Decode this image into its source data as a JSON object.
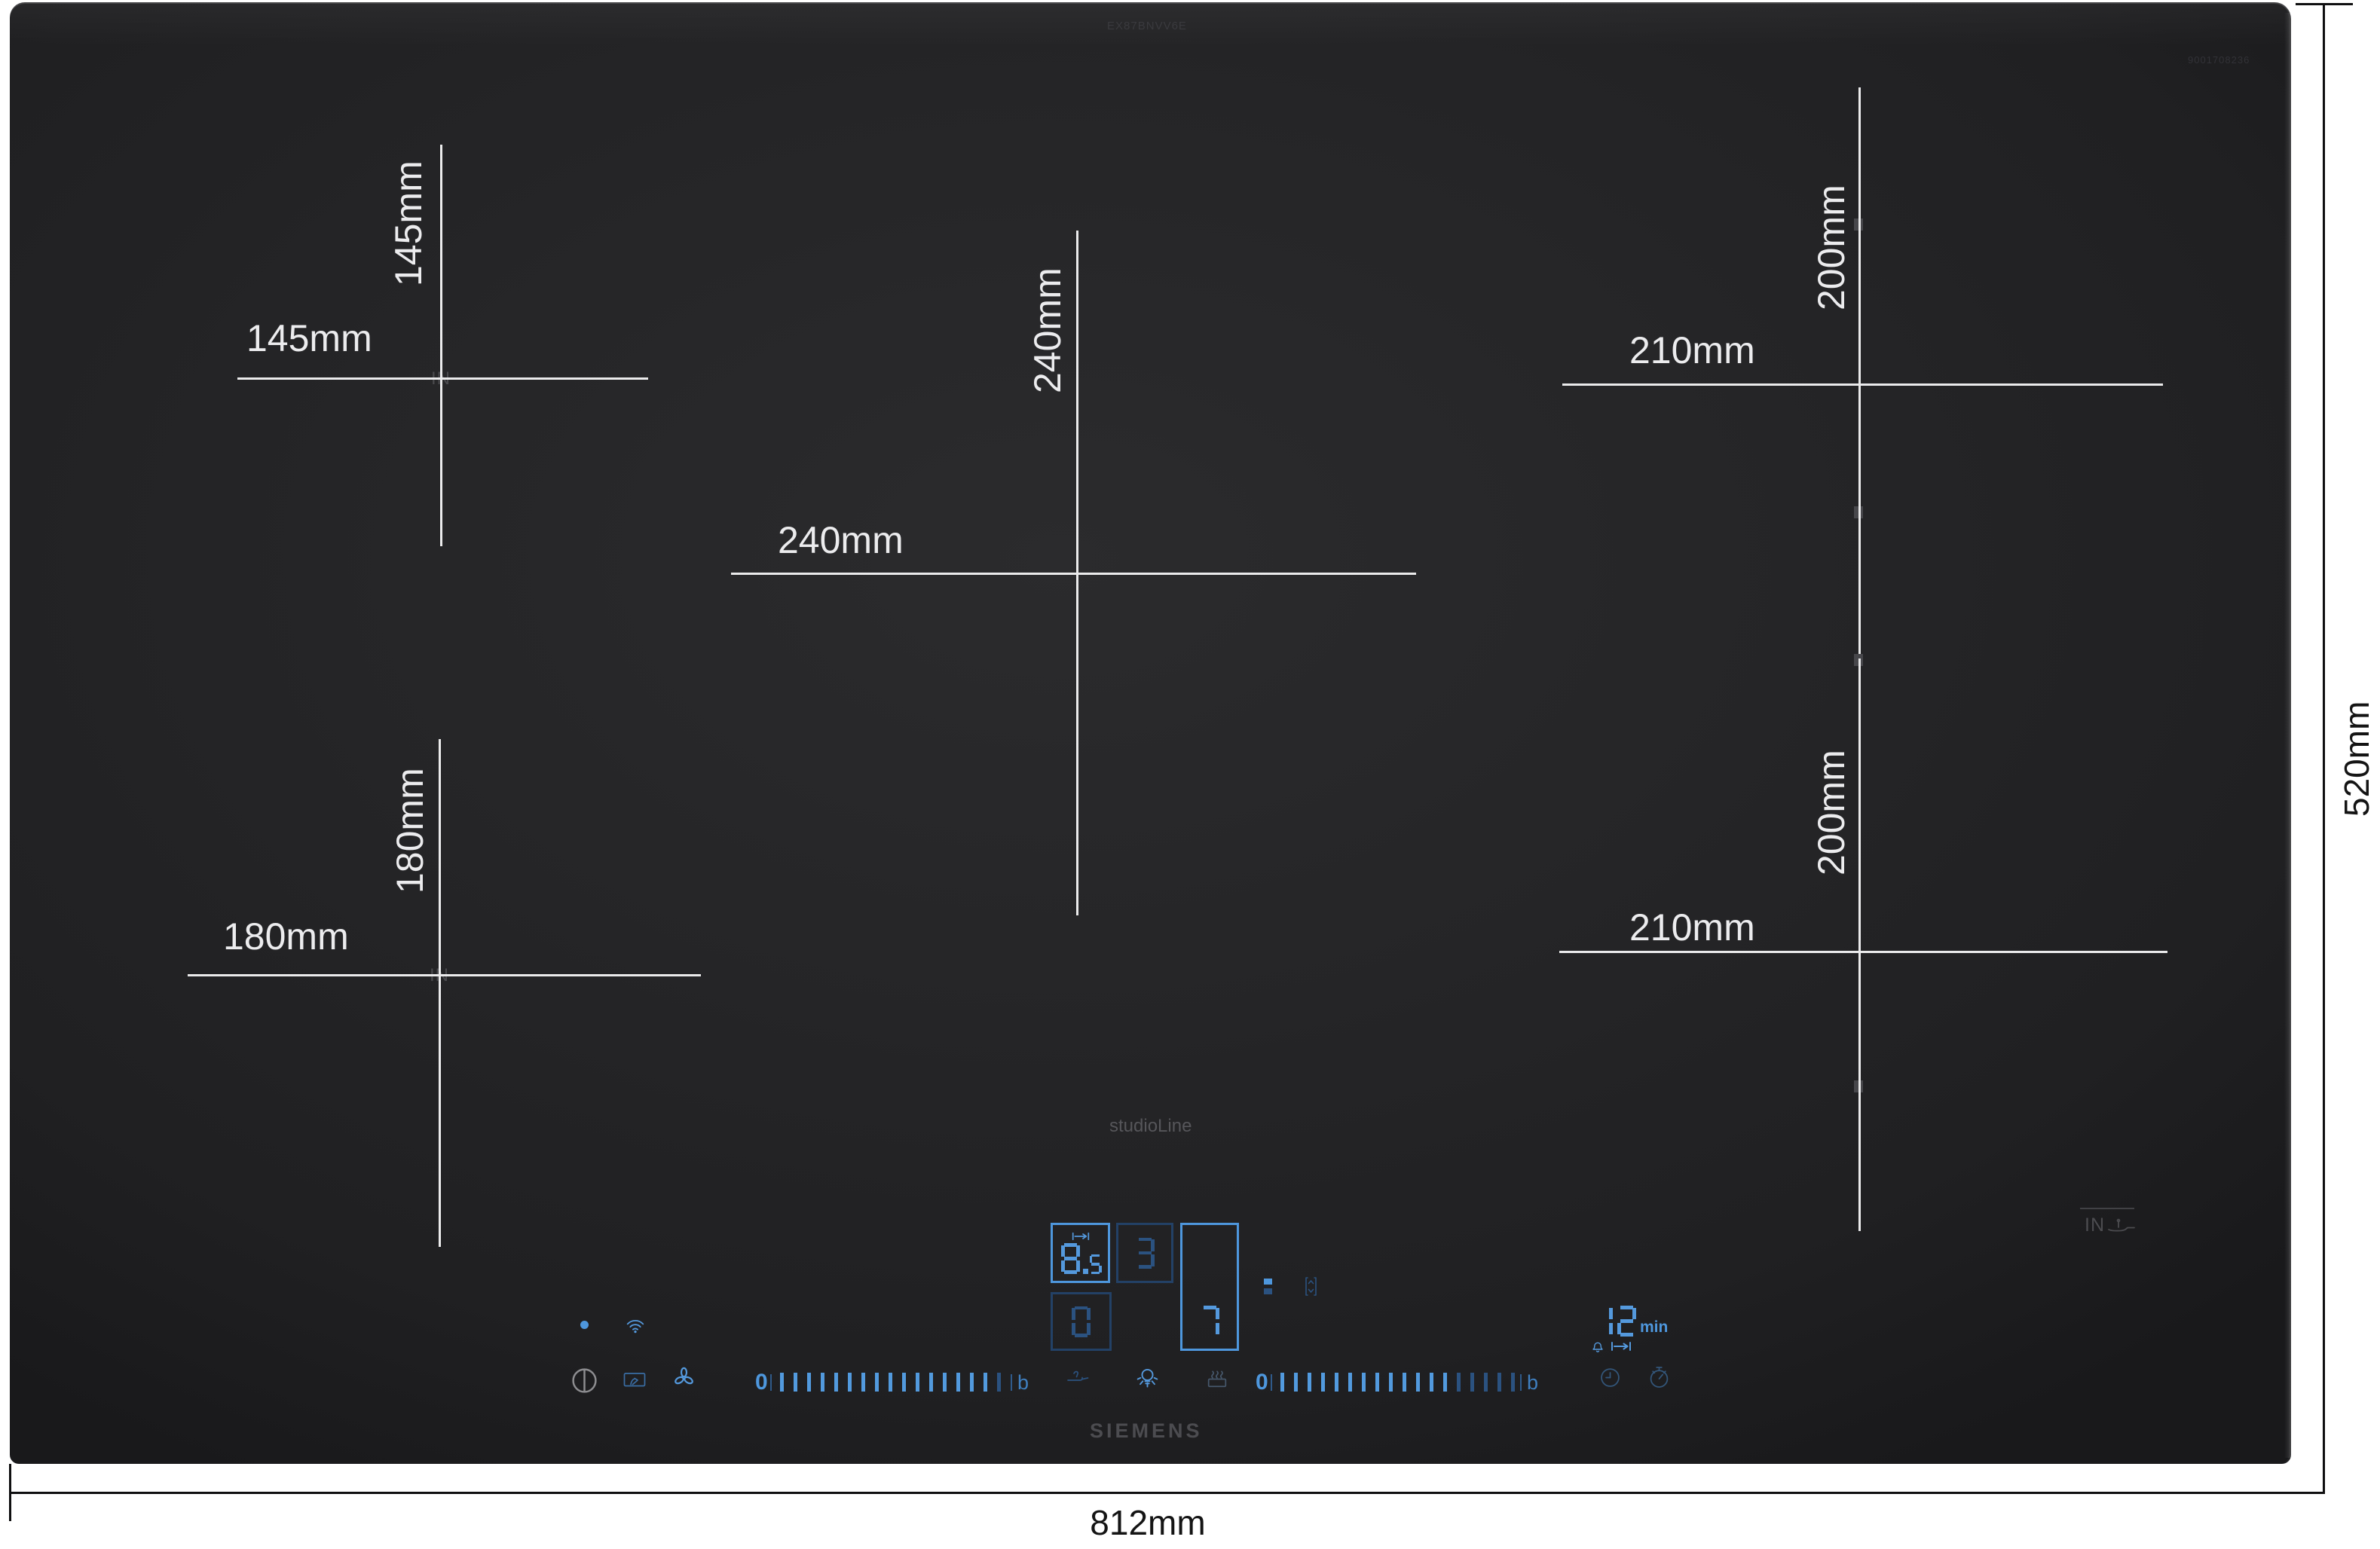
{
  "product": {
    "brand": "SIEMENS",
    "series": "studioLine",
    "model": "EX87BNVV6E",
    "part_number": "9001708236",
    "induction_mark": "IN"
  },
  "overall": {
    "width_label": "812mm",
    "height_label": "520mm"
  },
  "zones": [
    {
      "position": "left-rear",
      "width_label": "145mm",
      "height_label": "145mm",
      "surface_mark": "IN"
    },
    {
      "position": "left-front",
      "width_label": "180mm",
      "height_label": "180mm",
      "surface_mark": "IN"
    },
    {
      "position": "center",
      "width_label": "240mm",
      "height_label": "240mm"
    },
    {
      "position": "right-rear",
      "width_label": "210mm",
      "height_label": "200mm"
    },
    {
      "position": "right-front",
      "width_label": "210mm",
      "height_label": "200mm"
    }
  ],
  "controls": {
    "displays": {
      "flex_zone": {
        "value": "8.5"
      },
      "zone_rear": {
        "value": "3"
      },
      "zone_front": {
        "value": "0"
      },
      "zone_right": {
        "value": "7"
      }
    },
    "timer": {
      "value": "12",
      "unit": "min"
    },
    "sliders": {
      "left": {
        "min": "0",
        "max": "b",
        "bright": 16,
        "dim": 1
      },
      "right": {
        "min": "0",
        "max": "b",
        "bright": 13,
        "dim": 5
      }
    },
    "icons": [
      "power-icon",
      "wifi-icon",
      "wipe-protection-icon",
      "hood-fan-icon",
      "fry-sensor-icon",
      "light-icon",
      "pot-detection-icon",
      "pause-icon",
      "move-zone-icon",
      "alarm-bell-icon",
      "flex-width-icon",
      "clock-icon",
      "stopwatch-icon",
      "pan-sensor-icon"
    ]
  }
}
